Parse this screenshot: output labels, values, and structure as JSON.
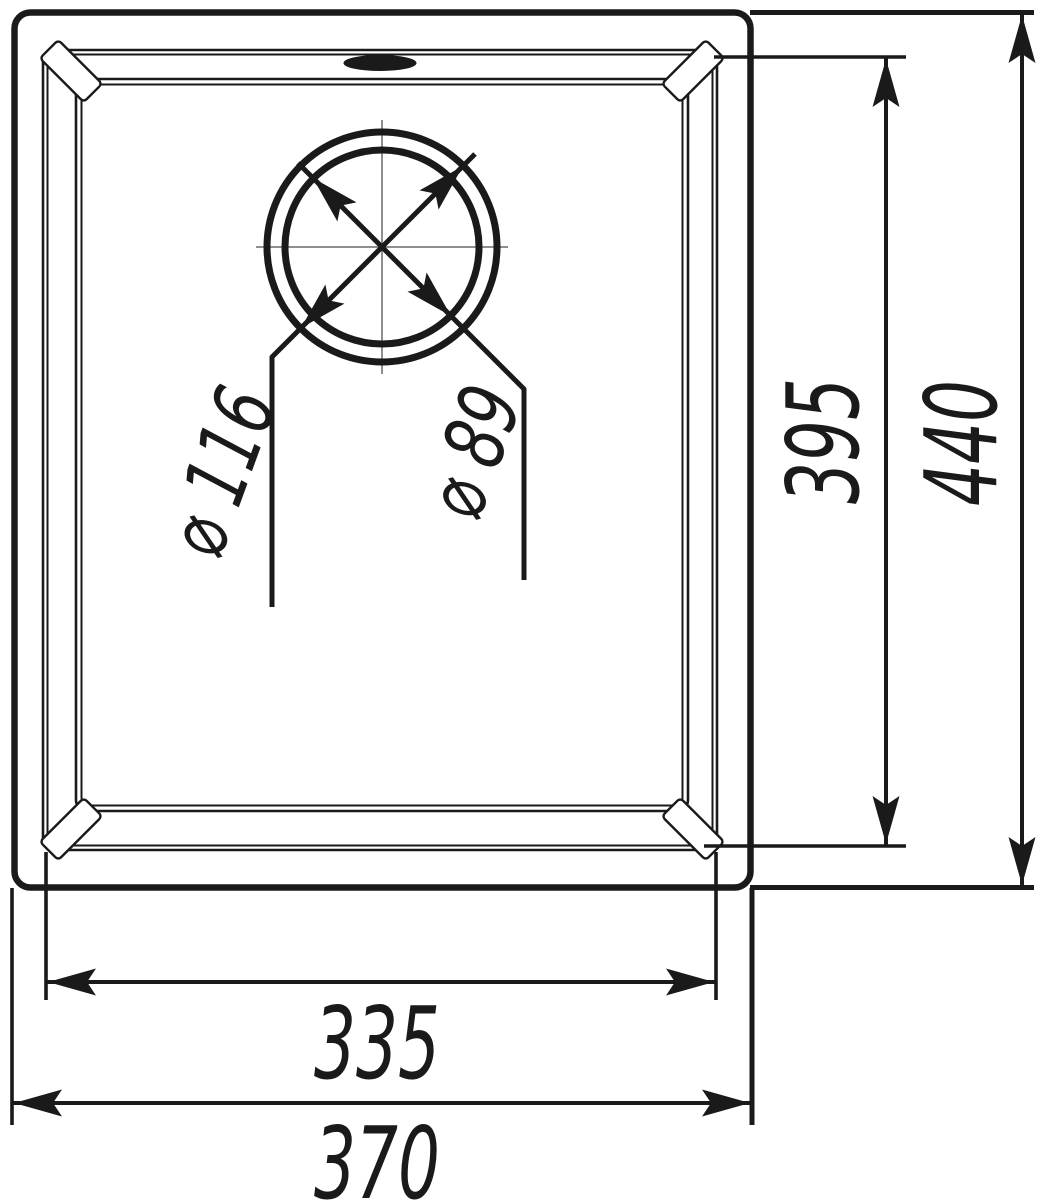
{
  "drawing": {
    "view": "sink-top-view-technical-drawing",
    "colors": {
      "line": "#1a1a1a",
      "centerline": "#8f8f8f",
      "background": "#ffffff"
    },
    "dimensions": {
      "overall_width": {
        "label": "370",
        "value": 370
      },
      "bowl_width": {
        "label": "335",
        "value": 335
      },
      "overall_depth": {
        "label": "440",
        "value": 440
      },
      "bowl_depth": {
        "label": "395",
        "value": 395
      },
      "drain_outer_diameter": {
        "label": "⌀ 116",
        "value": 116
      },
      "drain_inner_diameter": {
        "label": "⌀ 89",
        "value": 89
      }
    }
  }
}
